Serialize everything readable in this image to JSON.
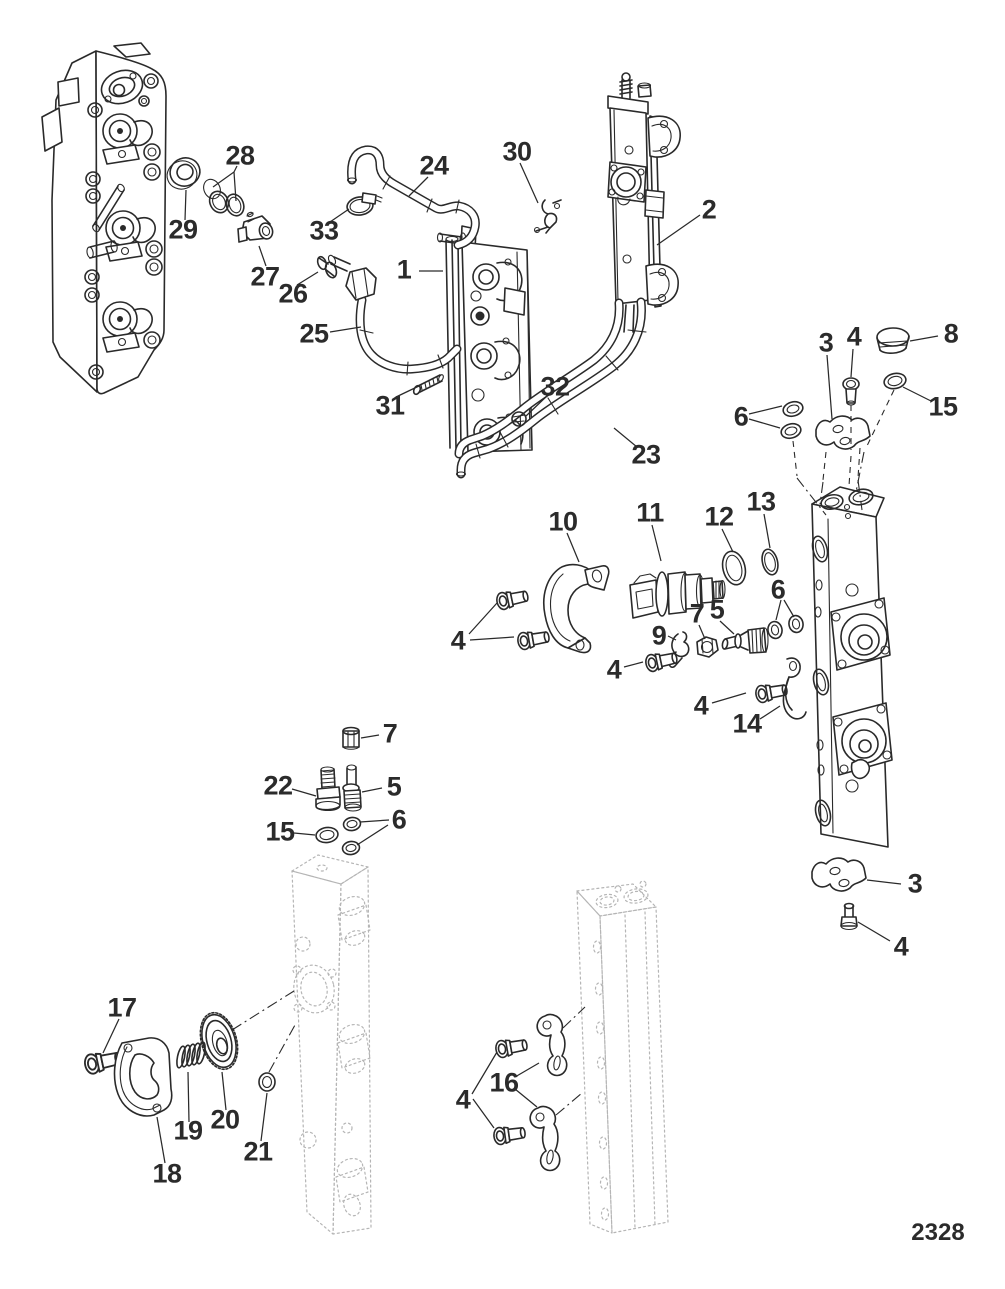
{
  "figure": {
    "page_number": "2328"
  },
  "callouts": [
    {
      "label": "28"
    },
    {
      "label": "29"
    },
    {
      "label": "33"
    },
    {
      "label": "27"
    },
    {
      "label": "26"
    },
    {
      "label": "24"
    },
    {
      "label": "30"
    },
    {
      "label": "2"
    },
    {
      "label": "1"
    },
    {
      "label": "25"
    },
    {
      "label": "31"
    },
    {
      "label": "32"
    },
    {
      "label": "23"
    },
    {
      "label": "3"
    },
    {
      "label": "4"
    },
    {
      "label": "8"
    },
    {
      "label": "6"
    },
    {
      "label": "15"
    },
    {
      "label": "10"
    },
    {
      "label": "11"
    },
    {
      "label": "12"
    },
    {
      "label": "13"
    },
    {
      "label": "4"
    },
    {
      "label": "9"
    },
    {
      "label": "7"
    },
    {
      "label": "5"
    },
    {
      "label": "6"
    },
    {
      "label": "4"
    },
    {
      "label": "4"
    },
    {
      "label": "14"
    },
    {
      "label": "7"
    },
    {
      "label": "22"
    },
    {
      "label": "5"
    },
    {
      "label": "15"
    },
    {
      "label": "6"
    },
    {
      "label": "3"
    },
    {
      "label": "4"
    },
    {
      "label": "17"
    },
    {
      "label": "19"
    },
    {
      "label": "20"
    },
    {
      "label": "18"
    },
    {
      "label": "21"
    },
    {
      "label": "4"
    },
    {
      "label": "16"
    }
  ]
}
